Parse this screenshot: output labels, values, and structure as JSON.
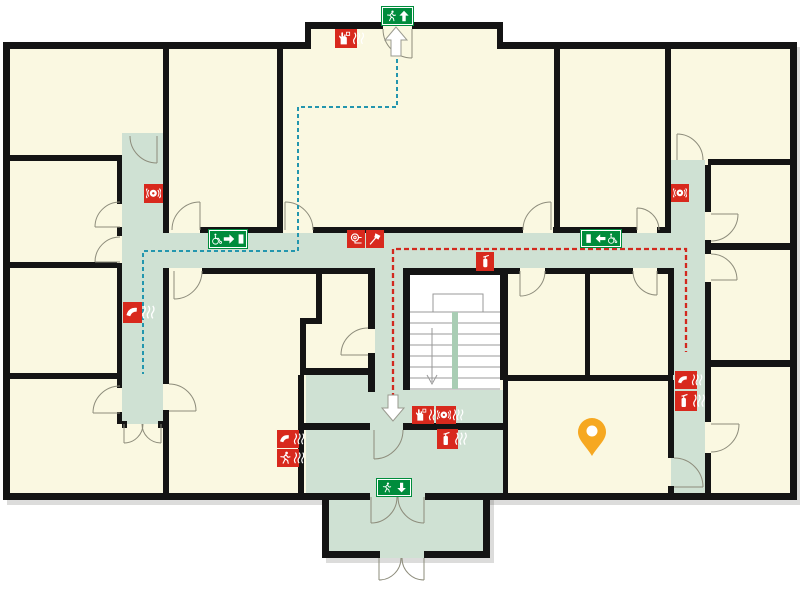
{
  "plan": {
    "title": "evacuation-floor-plan",
    "palette": {
      "room_fill": "#FAF8E1",
      "corridor_fill": "#CFE1D3",
      "wall": "#141414",
      "sign_red": "#D8291D",
      "sign_green": "#008C3C",
      "route_blue": "#2396AE",
      "route_red": "#D2281E",
      "marker_orange": "#F6A821",
      "door_arc": "#8d8c7b",
      "stair_line": "#999999"
    },
    "marker": {
      "name": "you-are-here-marker",
      "x": 592,
      "y": 433,
      "color": "#F6A821"
    },
    "arrows": [
      {
        "name": "exit-direction-up-arrow",
        "dir": "up",
        "x": 396,
        "y": 42
      },
      {
        "name": "exit-direction-down-arrow",
        "dir": "down",
        "x": 393,
        "y": 408
      }
    ],
    "routes": [
      {
        "name": "escape-route-blue",
        "color": "#2396AE",
        "width": 2,
        "dash": "4 3",
        "points": [
          [
            397,
            52
          ],
          [
            397,
            107
          ],
          [
            298,
            107
          ],
          [
            298,
            251
          ],
          [
            143,
            251
          ],
          [
            143,
            374
          ]
        ]
      },
      {
        "name": "escape-route-red",
        "color": "#D2281E",
        "width": 2.3,
        "dash": "5 3",
        "points": [
          [
            393,
            406
          ],
          [
            393,
            249
          ],
          [
            686,
            249
          ],
          [
            686,
            352
          ]
        ]
      }
    ],
    "signs": [
      {
        "name": "emergency-exit-up-sign",
        "kind": "green",
        "glyphs": [
          "run",
          "arrow-up"
        ],
        "x": 382,
        "y": 7,
        "w": 31,
        "h": 18
      },
      {
        "name": "manual-call-point-sign-top",
        "kind": "red",
        "glyphs": [
          "hand",
          "waves"
        ],
        "x": 335,
        "y": 29,
        "w": 22,
        "h": 19
      },
      {
        "name": "alarm-sounder-sign-left",
        "kind": "red",
        "glyphs": [
          "bell"
        ],
        "x": 144,
        "y": 184,
        "w": 19,
        "h": 19
      },
      {
        "name": "wheelchair-refuge-right-sign",
        "kind": "green",
        "glyphs": [
          "wheel",
          "arrow-right",
          "door"
        ],
        "x": 209,
        "y": 230,
        "w": 38,
        "h": 18
      },
      {
        "name": "fire-hose-reel-sign",
        "kind": "red",
        "glyphs": [
          "hose"
        ],
        "x": 347,
        "y": 230,
        "w": 18,
        "h": 18
      },
      {
        "name": "fire-axe-sign",
        "kind": "red",
        "glyphs": [
          "axe"
        ],
        "x": 366,
        "y": 230,
        "w": 18,
        "h": 18
      },
      {
        "name": "extinguisher-sign-center",
        "kind": "red",
        "glyphs": [
          "ext"
        ],
        "x": 476,
        "y": 252,
        "w": 18,
        "h": 19
      },
      {
        "name": "alarm-sounder-sign-right",
        "kind": "red",
        "glyphs": [
          "bell"
        ],
        "x": 671,
        "y": 184,
        "w": 18,
        "h": 18
      },
      {
        "name": "wheelchair-refuge-left-sign",
        "kind": "green",
        "glyphs": [
          "door",
          "arrow-left",
          "wheel"
        ],
        "x": 581,
        "y": 230,
        "w": 40,
        "h": 17
      },
      {
        "name": "emergency-phone-sign-left",
        "kind": "red",
        "glyphs": [
          "phone",
          "waves"
        ],
        "x": 123,
        "y": 302,
        "w": 19,
        "h": 21
      },
      {
        "name": "emergency-phone-sign-room",
        "kind": "red",
        "glyphs": [
          "phone",
          "waves"
        ],
        "x": 277,
        "y": 430,
        "w": 22,
        "h": 18
      },
      {
        "name": "evacuation-alarm-sign-room",
        "kind": "red",
        "glyphs": [
          "run",
          "waves"
        ],
        "x": 277,
        "y": 449,
        "w": 22,
        "h": 18
      },
      {
        "name": "manual-call-point-sign-landing",
        "kind": "red",
        "glyphs": [
          "hand",
          "waves"
        ],
        "x": 412,
        "y": 406,
        "w": 22,
        "h": 18
      },
      {
        "name": "alarm-sounder-sign-landing",
        "kind": "red",
        "glyphs": [
          "bell",
          "waves"
        ],
        "x": 436,
        "y": 406,
        "w": 20,
        "h": 18
      },
      {
        "name": "extinguisher-sign-landing",
        "kind": "red",
        "glyphs": [
          "ext",
          "waves"
        ],
        "x": 437,
        "y": 429,
        "w": 21,
        "h": 20
      },
      {
        "name": "emergency-phone-sign-east",
        "kind": "red",
        "glyphs": [
          "phone",
          "waves"
        ],
        "x": 675,
        "y": 371,
        "w": 22,
        "h": 18
      },
      {
        "name": "extinguisher-sign-east",
        "kind": "red",
        "glyphs": [
          "ext",
          "waves"
        ],
        "x": 675,
        "y": 391,
        "w": 22,
        "h": 20
      },
      {
        "name": "emergency-exit-down-sign",
        "kind": "green",
        "glyphs": [
          "run",
          "arrow-down"
        ],
        "x": 377,
        "y": 479,
        "w": 34,
        "h": 17
      }
    ]
  }
}
